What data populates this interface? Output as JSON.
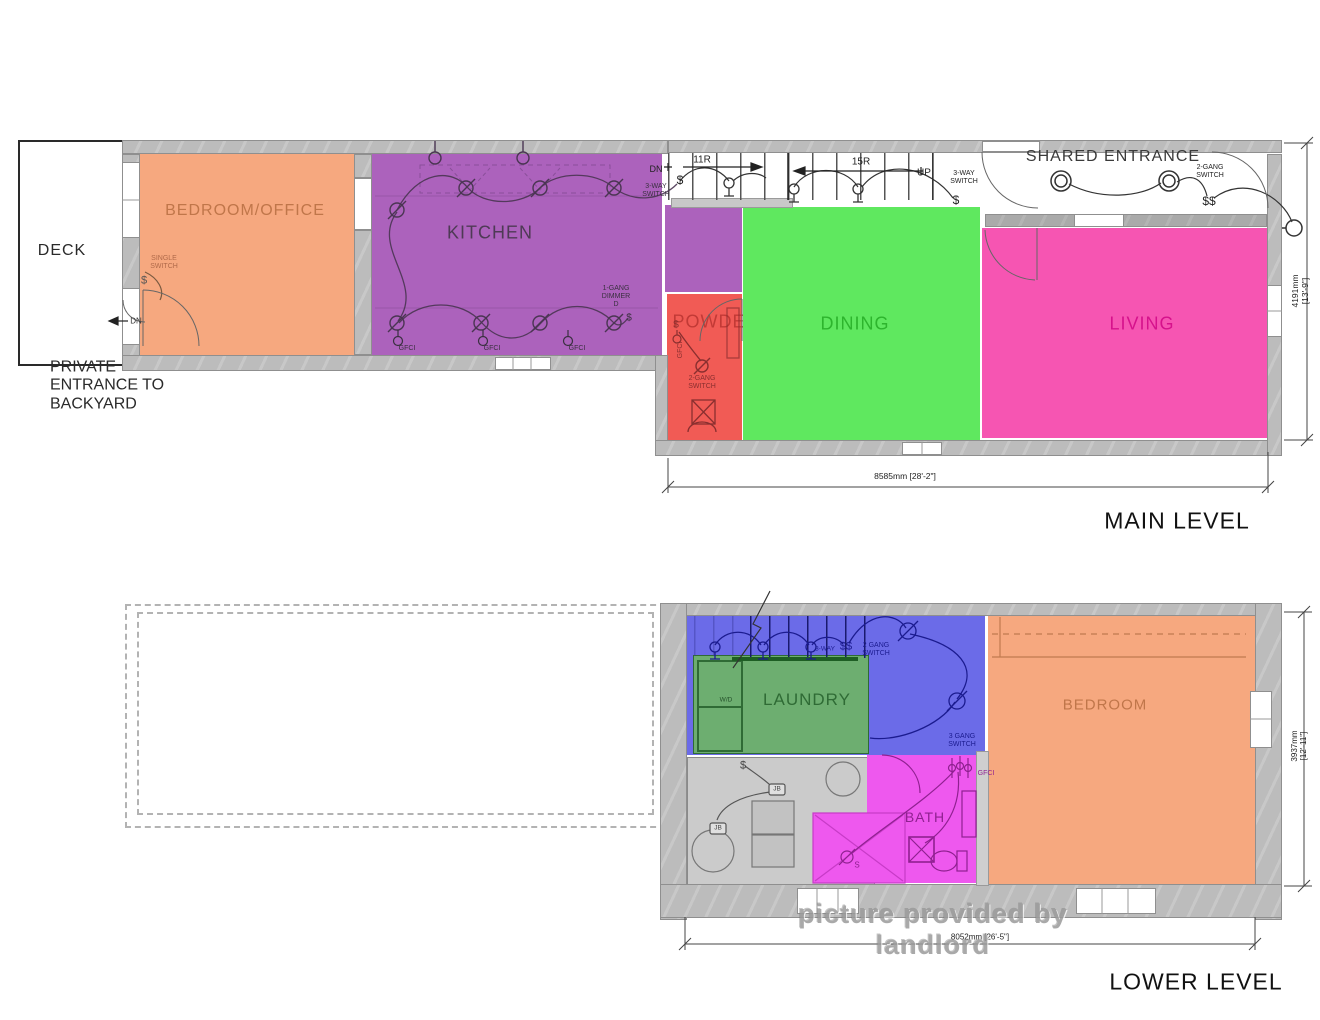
{
  "main_level": {
    "title": "MAIN LEVEL",
    "deck": "DECK",
    "shared_entrance": "SHARED ENTRANCE",
    "rooms": {
      "bedroom_office": "BEDROOM/OFFICE",
      "kitchen": "KITCHEN",
      "powder": "POWDER",
      "dining": "DINING",
      "living": "LIVING"
    },
    "dims": {
      "bottom": "8585mm [28'-2\"]",
      "right": "4191mm [13'-9\"]"
    }
  },
  "lower_level": {
    "title": "LOWER LEVEL",
    "rooms": {
      "laundry": "LAUNDRY",
      "bedroom": "BEDROOM",
      "bath": "BATH",
      "mech": "MECH"
    },
    "dims": {
      "bottom": "8052mm [26'-5\"]",
      "right": "3937mm [12'-11\"]"
    }
  },
  "watermark": "picture provided by landlord",
  "colors": {
    "room_orange": "#F6A87F",
    "room_purple": "#AC62BC",
    "room_red": "#F15B55",
    "room_green": "#5FE85F",
    "room_pink": "#F655B2",
    "room_blue": "#6B6BE8",
    "room_laundry": "#6DAE70",
    "room_magenta": "#EE58EE",
    "room_gray": "#CBCBCB",
    "label_orange": "#C0764A",
    "label_kitchen": "#4E3A55",
    "label_red": "#C23A36",
    "label_dining": "#2DB52D",
    "label_pink": "#D6128C",
    "label_laundry": "#2F6B35",
    "label_bath": "#8F2090",
    "label_mech": "#666666",
    "label_dark": "#2A2A2A",
    "wall_gray": "#BCBCBC",
    "line_dark": "#333333"
  },
  "annotations": [
    {
      "t": "PRIVATE\nENTRANCE TO\nBACKYARD",
      "x": 50,
      "y": 386,
      "s": 16,
      "c": "#2a2a2a",
      "align": "left"
    },
    {
      "t": "SINGLE\nSWITCH",
      "x": 164,
      "y": 263,
      "s": 7,
      "c": "#b06a4a"
    },
    {
      "t": "$",
      "x": 144,
      "y": 281,
      "s": 11,
      "c": "#555555"
    },
    {
      "t": "DN",
      "x": 136,
      "y": 321,
      "s": 8,
      "c": "#333333"
    },
    {
      "t": "GFCI",
      "x": 407,
      "y": 349,
      "s": 7,
      "c": "#3a3040"
    },
    {
      "t": "GFCI",
      "x": 492,
      "y": 349,
      "s": 7,
      "c": "#3a3040"
    },
    {
      "t": "GFCI",
      "x": 577,
      "y": 349,
      "s": 7,
      "c": "#3a3040"
    },
    {
      "t": "1-GANG\nDIMMER\nD",
      "x": 616,
      "y": 297,
      "s": 7,
      "c": "#3a3040"
    },
    {
      "t": "$",
      "x": 629,
      "y": 318,
      "s": 10,
      "c": "#3a3040"
    },
    {
      "t": "DN",
      "x": 656,
      "y": 169,
      "s": 9,
      "c": "#222222"
    },
    {
      "t": "3-WAY\nSWITCH",
      "x": 656,
      "y": 191,
      "s": 7,
      "c": "#3a3040"
    },
    {
      "t": "$",
      "x": 680,
      "y": 181,
      "s": 12,
      "c": "#222222"
    },
    {
      "t": "11R",
      "x": 702,
      "y": 160,
      "s": 10,
      "c": "#222222"
    },
    {
      "t": "15R",
      "x": 861,
      "y": 162,
      "s": 10,
      "c": "#222222"
    },
    {
      "t": "UP",
      "x": 924,
      "y": 173,
      "s": 10,
      "c": "#222222"
    },
    {
      "t": "3-WAY\nSWITCH",
      "x": 964,
      "y": 178,
      "s": 7,
      "c": "#222222"
    },
    {
      "t": "$",
      "x": 956,
      "y": 201,
      "s": 12,
      "c": "#222222"
    },
    {
      "t": "2-GANG\nSWITCH",
      "x": 1210,
      "y": 172,
      "s": 7,
      "c": "#222222"
    },
    {
      "t": "$$",
      "x": 1209,
      "y": 202,
      "s": 12,
      "c": "#222222"
    },
    {
      "t": "$",
      "x": 676,
      "y": 325,
      "s": 10,
      "c": "#8a2f2f"
    },
    {
      "t": "GFCI",
      "x": 681,
      "y": 350,
      "s": 7,
      "c": "#8a2f2f",
      "r": -90
    },
    {
      "t": "2-GANG\nSWITCH",
      "x": 702,
      "y": 383,
      "s": 7,
      "c": "#8a2f2f"
    },
    {
      "t": "3-WAY",
      "x": 825,
      "y": 649,
      "s": 6.5,
      "c": "#1b1b8f"
    },
    {
      "t": "$$",
      "x": 846,
      "y": 647,
      "s": 11,
      "c": "#1b1b8f"
    },
    {
      "t": "2 GANG\nSWITCH",
      "x": 876,
      "y": 650,
      "s": 7,
      "c": "#1b1b8f"
    },
    {
      "t": "3 GANG\nSWITCH",
      "x": 962,
      "y": 741,
      "s": 7,
      "c": "#1b1b8f"
    },
    {
      "t": "W/D",
      "x": 726,
      "y": 700,
      "s": 6.5,
      "c": "#24502a"
    },
    {
      "t": "$",
      "x": 743,
      "y": 766,
      "s": 11,
      "c": "#444444"
    },
    {
      "t": "JB",
      "x": 777,
      "y": 789,
      "s": 6.5,
      "c": "#444444"
    },
    {
      "t": "JB",
      "x": 718,
      "y": 828,
      "s": 6.5,
      "c": "#444444"
    },
    {
      "t": "S",
      "x": 857,
      "y": 865,
      "s": 8,
      "c": "#8f2090"
    },
    {
      "t": "GFCI",
      "x": 986,
      "y": 774,
      "s": 7,
      "c": "#8f2090"
    }
  ],
  "dim_annotations": [
    {
      "bind": "main_level.dims.bottom",
      "x": 905,
      "y": 477,
      "s": 8.5,
      "c": "#222222"
    },
    {
      "bind": "main_level.dims.right",
      "x": 1301,
      "y": 291,
      "s": 8.5,
      "c": "#222222",
      "r": -90
    },
    {
      "bind": "lower_level.dims.bottom",
      "x": 980,
      "y": 937,
      "s": 8,
      "c": "#222222"
    },
    {
      "bind": "lower_level.dims.right",
      "x": 1299,
      "y": 746,
      "s": 8,
      "c": "#222222",
      "r": -90
    }
  ]
}
